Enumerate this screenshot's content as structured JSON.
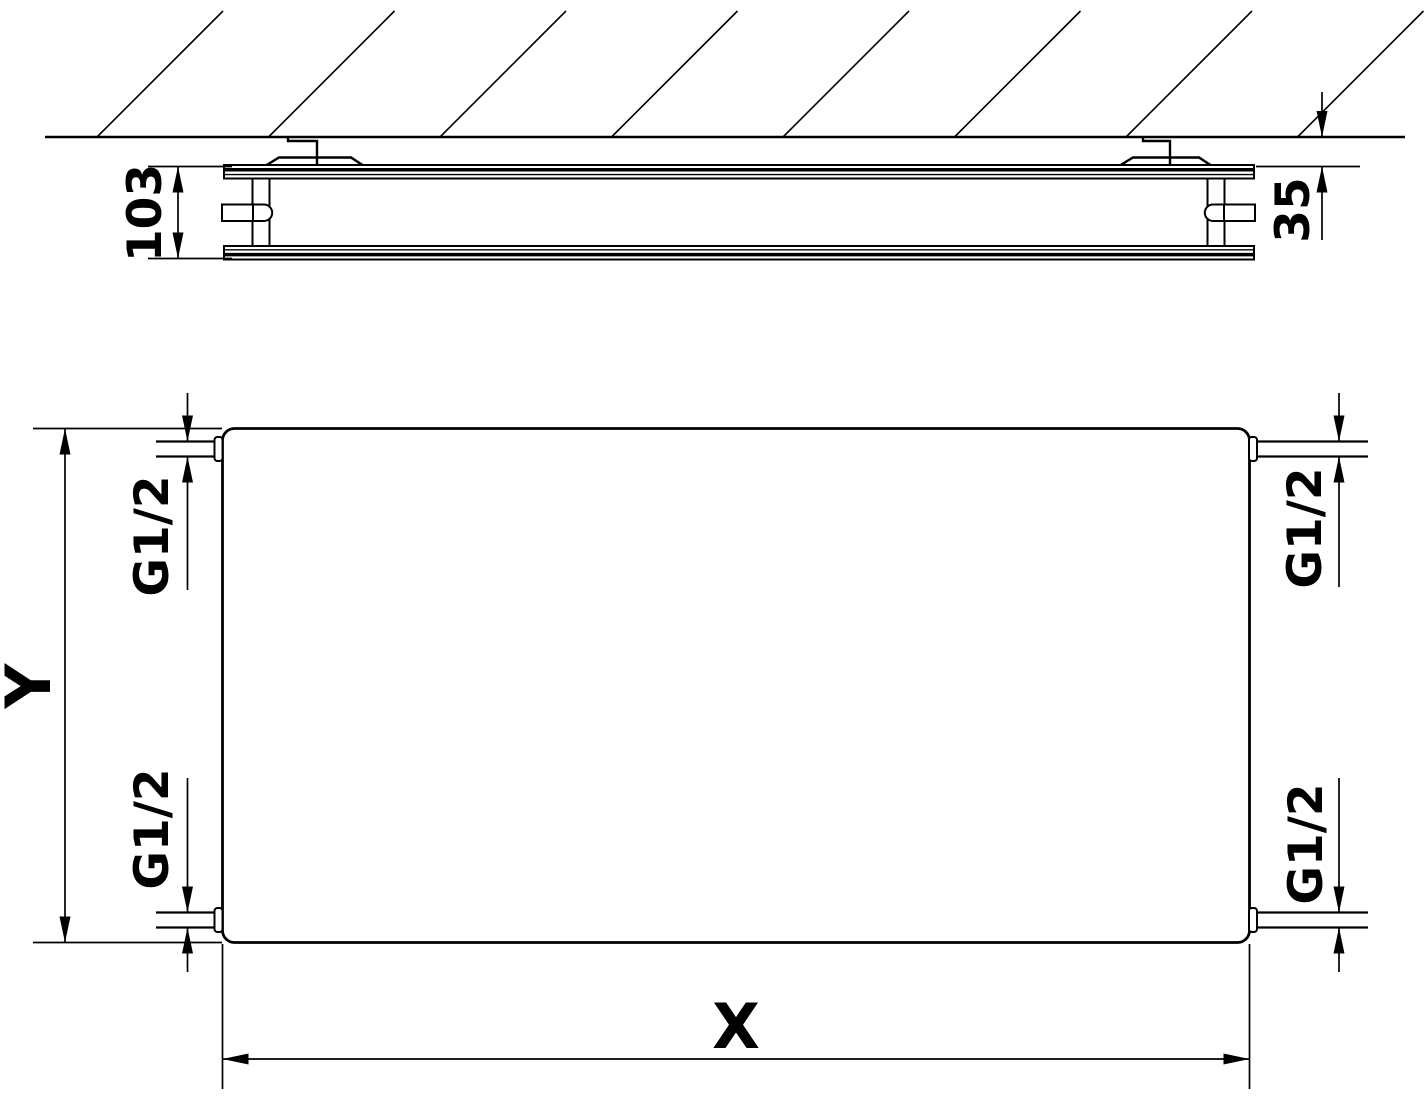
{
  "side_view": {
    "depth": "103",
    "wall_offset": "35"
  },
  "front_view": {
    "width": "X",
    "height": "Y",
    "connections": {
      "top_left": "G1/2",
      "top_right": "G1/2",
      "bottom_left": "G1/2",
      "bottom_right": "G1/2"
    }
  },
  "colors": {
    "line": "#000000",
    "background": "#ffffff"
  }
}
